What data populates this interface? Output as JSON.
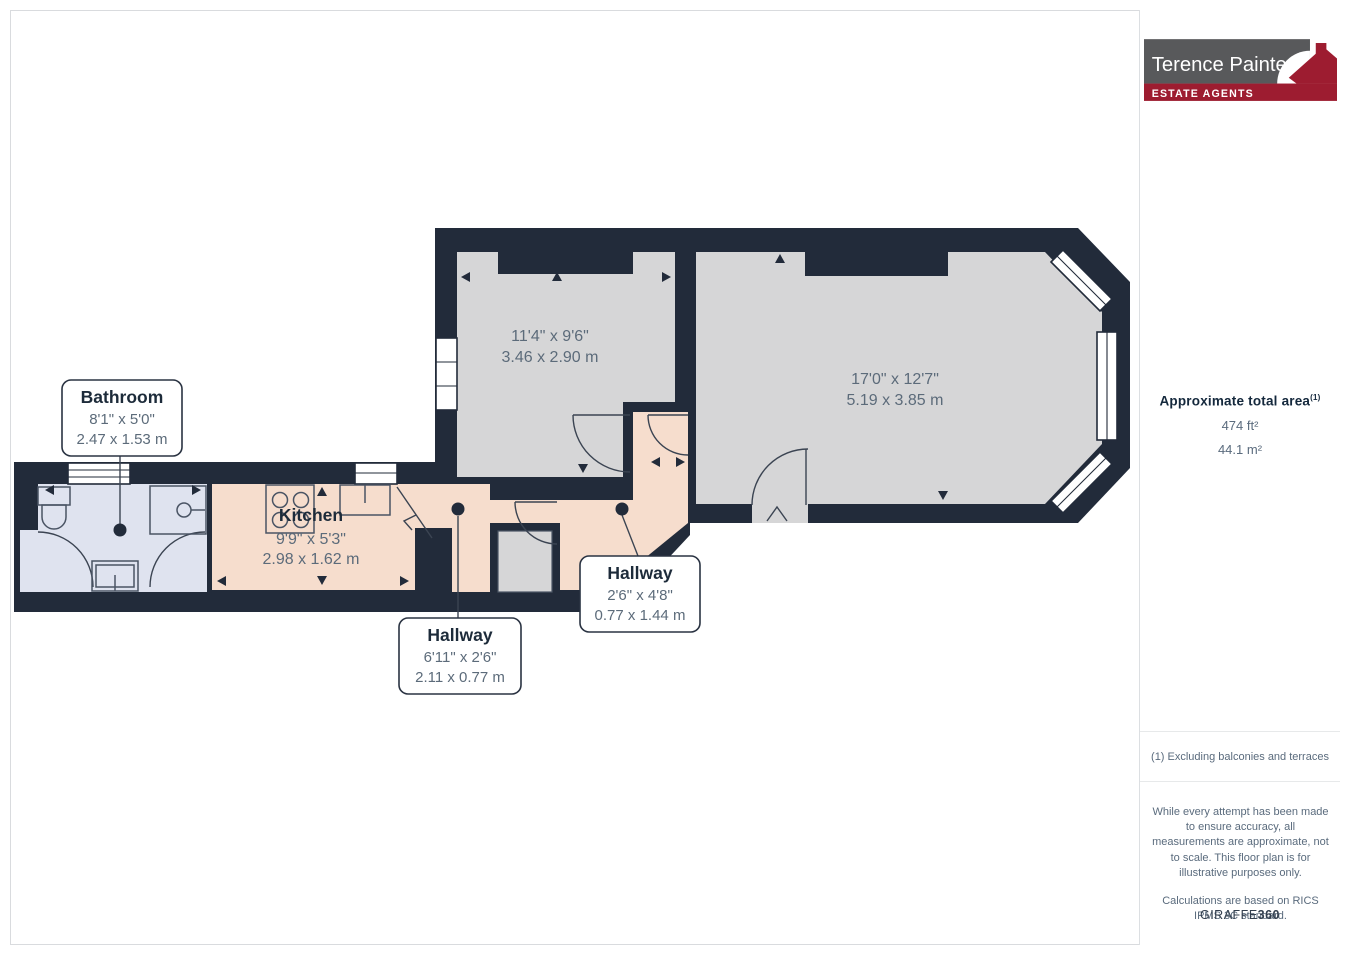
{
  "branding": {
    "name": "Terence Painter",
    "tagline": "ESTATE AGENTS"
  },
  "sidebar": {
    "area_title": "Approximate total area",
    "area_sup": "(1)",
    "area_imperial": "474 ft²",
    "area_metric": "44.1 m²",
    "footnote": "(1) Excluding balconies and terraces",
    "disclaimer_accuracy": "While every attempt has been made to ensure accuracy, all measurements are approximate, not to scale. This floor plan is for illustrative purposes only.",
    "disclaimer_calc": "Calculations are based on RICS IPMS 3C standard.",
    "brand_prefix": "GIRAFFE",
    "brand_suffix": "360"
  },
  "rooms": {
    "room1": {
      "imperial": "11'4\" x 9'6\"",
      "metric": "3.46 x 2.90 m"
    },
    "room2": {
      "imperial": "17'0\" x 12'7\"",
      "metric": "5.19 x 3.85 m"
    },
    "kitchen": {
      "name": "Kitchen",
      "imperial": "9'9\" x 5'3\"",
      "metric": "2.98 x 1.62 m"
    },
    "bathroom": {
      "name": "Bathroom",
      "imperial": "8'1\" x 5'0\"",
      "metric": "2.47 x 1.53 m"
    },
    "hallway_a": {
      "name": "Hallway",
      "imperial": "6'11\" x 2'6\"",
      "metric": "2.11 x 0.77 m"
    },
    "hallway_b": {
      "name": "Hallway",
      "imperial": "2'6\" x 4'8\"",
      "metric": "0.77 x 1.44 m"
    }
  },
  "colors": {
    "wall": "#222b3a",
    "room_gray": "#d6d6d7",
    "kitchen_peach": "#f6ddcd",
    "bathroom_blue": "#dfe3ef",
    "brand_red": "#9d1c30",
    "brand_gray": "#58595b"
  }
}
